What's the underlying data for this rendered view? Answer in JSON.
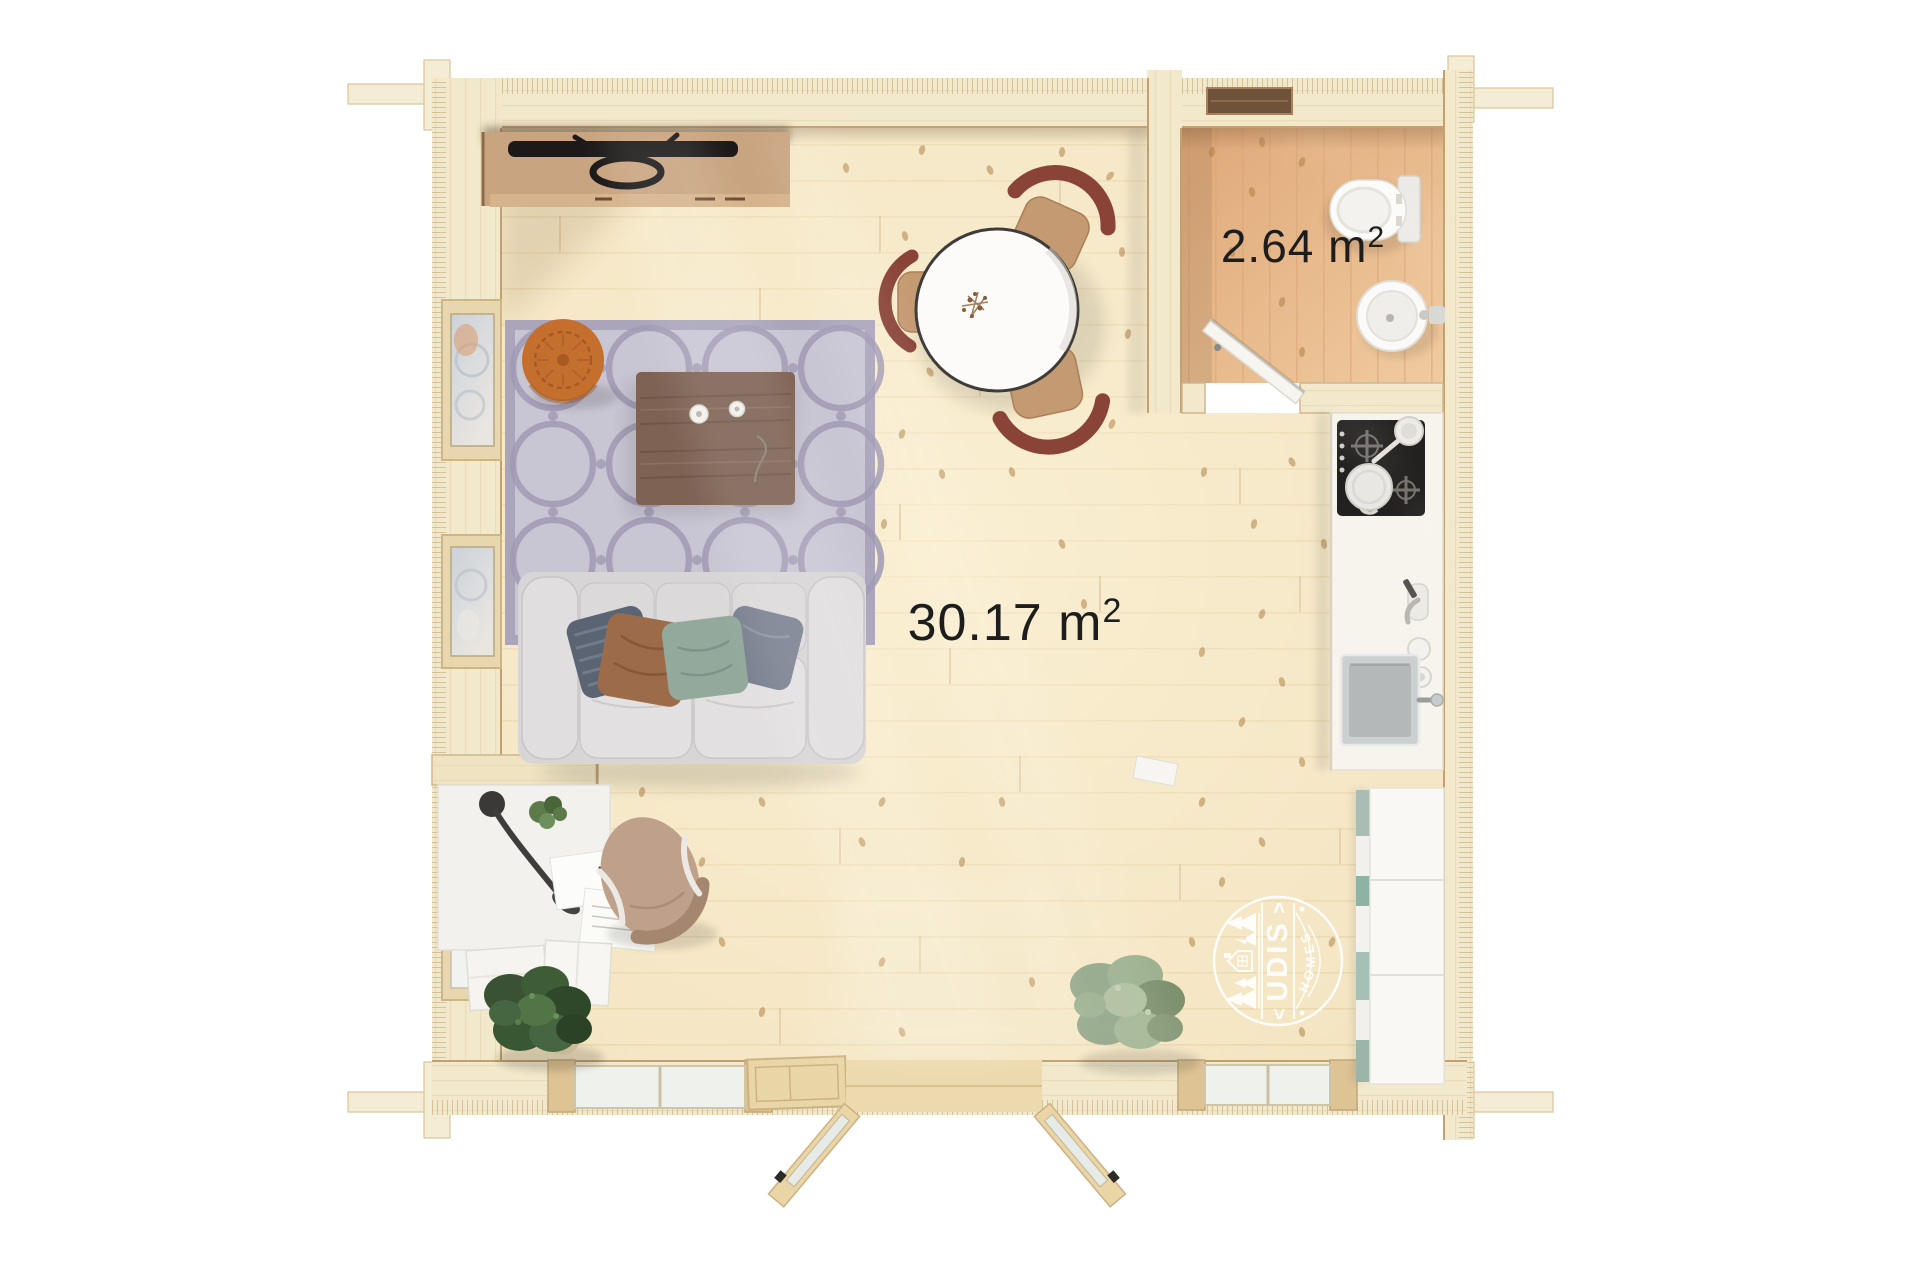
{
  "page": {
    "background": "#ffffff"
  },
  "labels": {
    "main_room": {
      "area": "30.17 m",
      "sup": "2"
    },
    "bathroom": {
      "area": "2.64 m",
      "sup": "2"
    }
  },
  "watermark": {
    "brand": "UDIS",
    "word": "HOMES",
    "chevron_left": "<",
    "chevron_right": ">"
  },
  "colors": {
    "floor": "#f4e5c2",
    "bathroom_floor": "#e9bb8c",
    "walls": "#f2e8cb",
    "rug": "#c9c6d4",
    "rug_pattern": "#a09ab4",
    "sofa": "#d8d5d6",
    "pouf": "#c56f2f",
    "coffee_table": "#7e6254",
    "console_wood": "#c9a480",
    "tv": "#1c1a19",
    "dining_chair": "#8a4337",
    "chair_seat": "#c49a72",
    "cooktop": "#232120",
    "plant_dark": "#3a5233",
    "plant_sage": "#93a687",
    "watermark": "#ffffff",
    "label_text": "#1d1d1d"
  }
}
